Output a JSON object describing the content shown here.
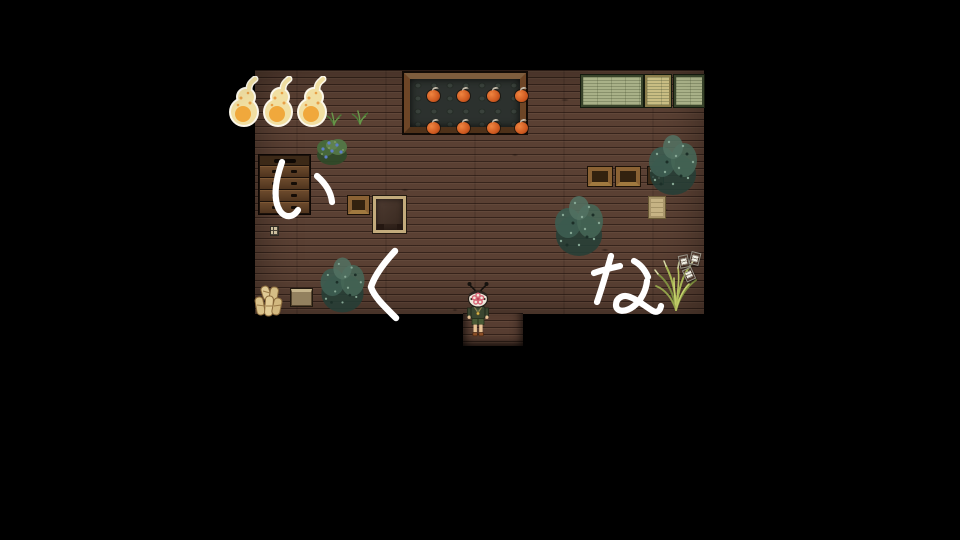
{
  "overlay": {
    "text": "いくな",
    "chars": [
      "い",
      "く",
      "な"
    ],
    "color": "#ffffff"
  },
  "scene": {
    "background_color": "#000000",
    "floor_color": "#5a4033",
    "room_label": "dark wooden room",
    "objects": {
      "gourd_lanterns": {
        "label": "gourd-lanterns",
        "count": 3,
        "body_color": "#f1dfa2",
        "core_color": "#f0a83c"
      },
      "persimmon_table": {
        "label": "persimmon-table",
        "fruit_count": 8,
        "fruit_color": "#cf5a20",
        "frame_color": "#6d4526"
      },
      "tatami_mats": {
        "label": "tatami-mats",
        "count": 3,
        "colors": [
          "#a9b188",
          "#c9bd83",
          "#a9b188"
        ]
      },
      "dresser": {
        "label": "dresser",
        "drawer_rows": 4
      },
      "crates": {
        "label": "wooden-crates",
        "count": 3
      },
      "bushes": {
        "label": "bushes",
        "count": 4
      },
      "papers": {
        "label": "scattered-papers",
        "count": 3
      },
      "straw_bundle": {
        "label": "straw-bundle"
      },
      "player": {
        "label": "masked-character",
        "mask_color": "#efe9dc",
        "flower_color": "#d86878",
        "outfit_color": "#3a4630"
      }
    }
  }
}
